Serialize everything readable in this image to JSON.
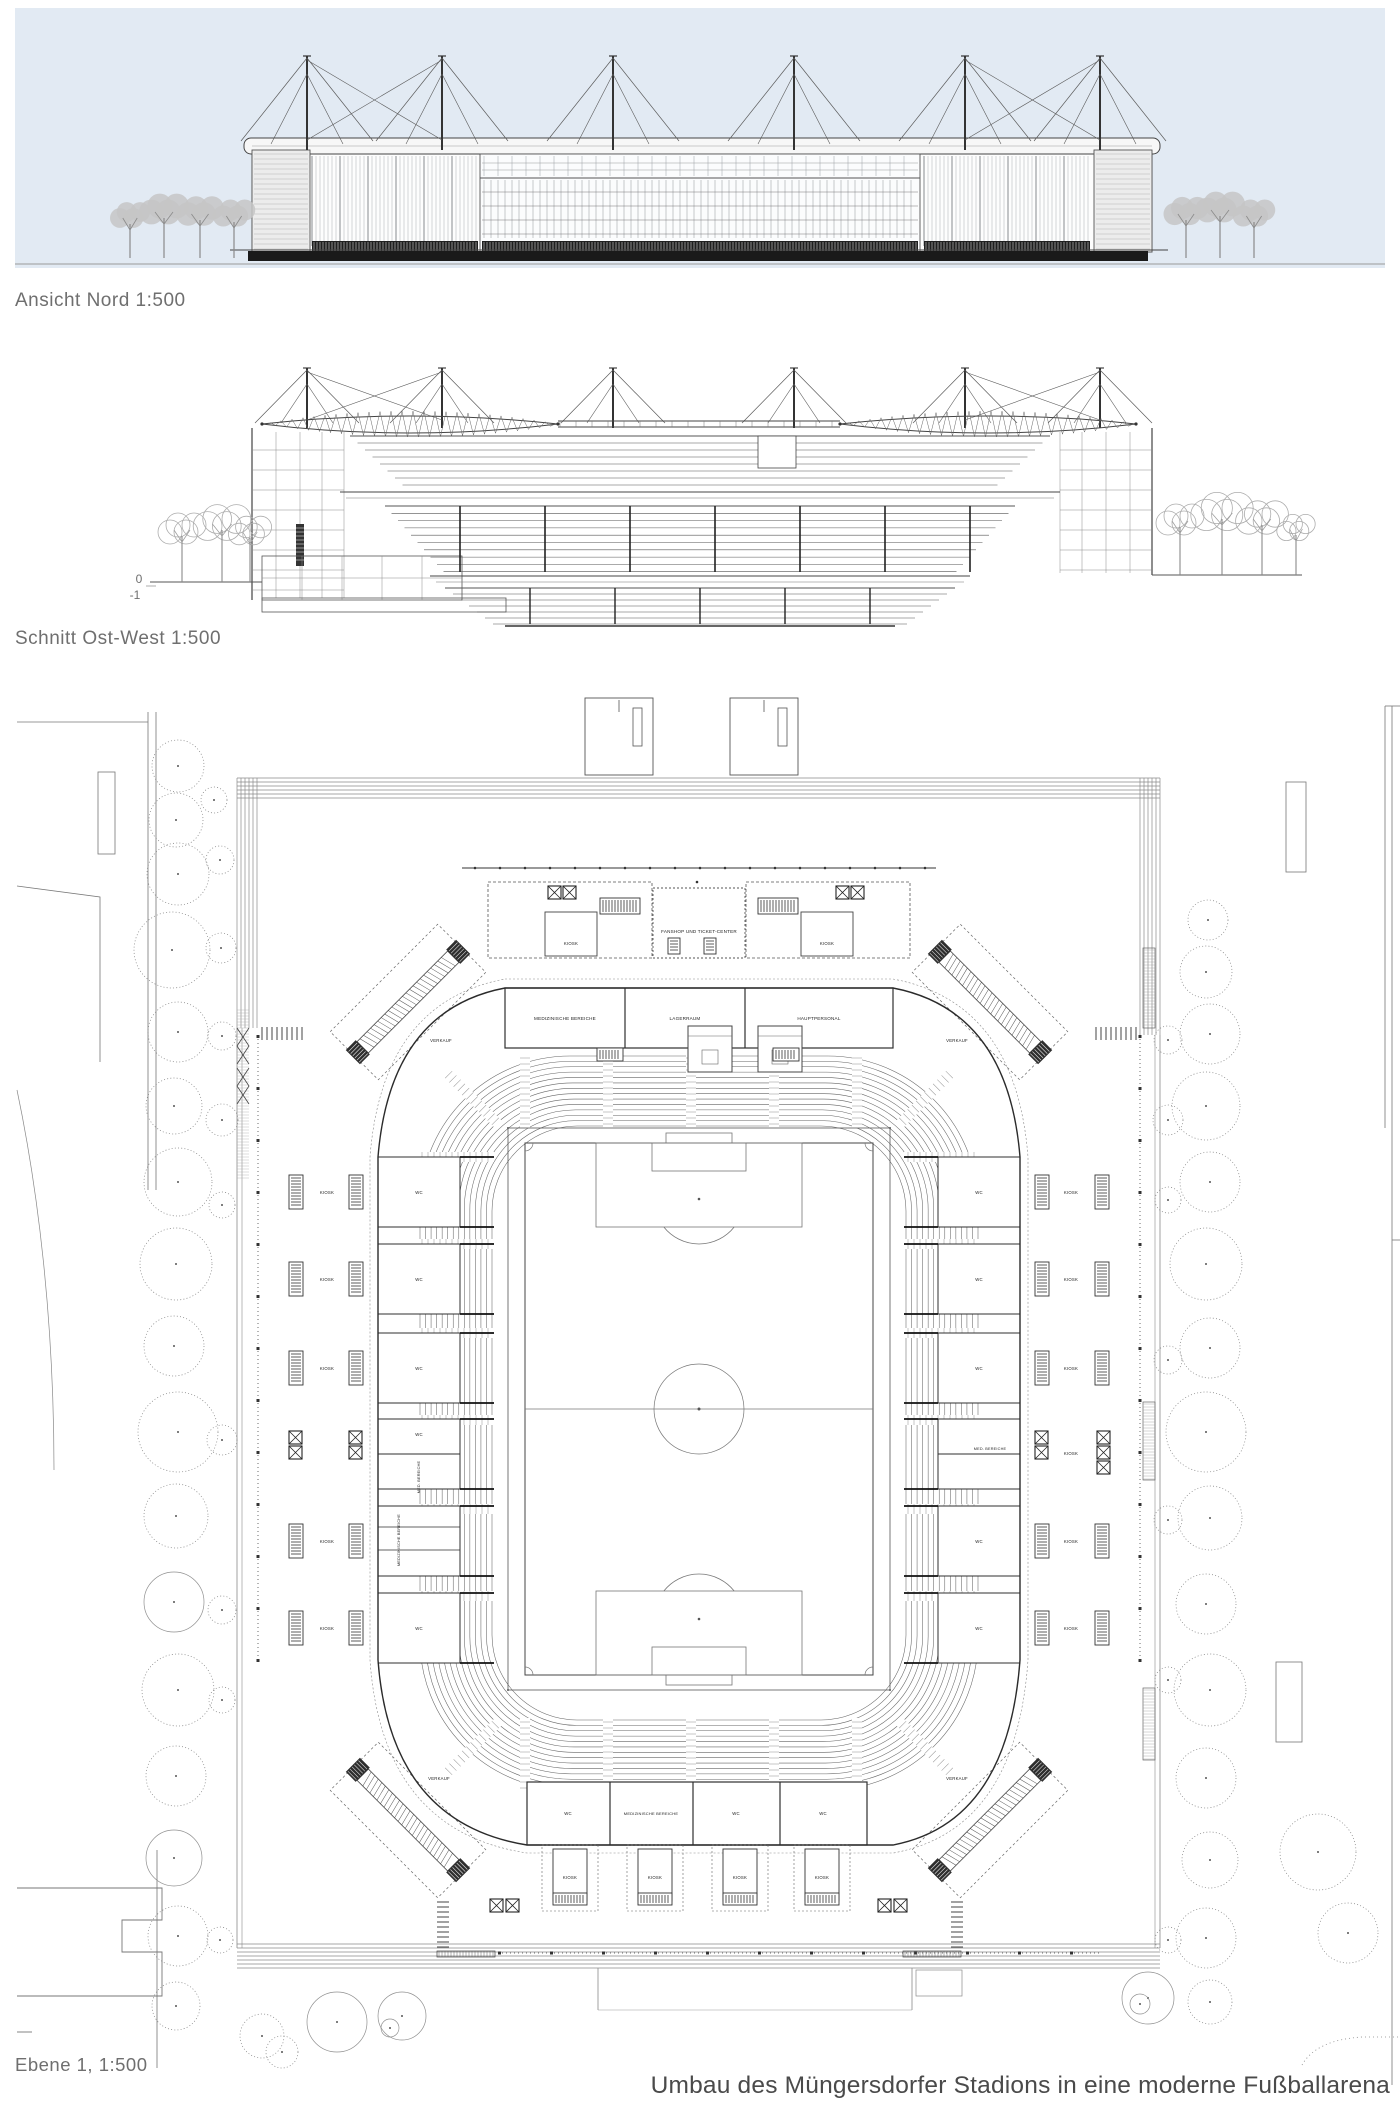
{
  "title_block": {
    "text": "Umbau des Müngersdorfer Stadions in eine moderne Fußballarena"
  },
  "captions": {
    "elevation": "Ansicht Nord 1:500",
    "section": "Schnitt Ost-West 1:500",
    "plan": "Ebene 1, 1:500"
  },
  "section": {
    "level_upper": "0",
    "level_lower": "-1"
  },
  "colors": {
    "sky": "#e2eaf3",
    "ground": "#1a1a1a",
    "ink": "#4a4a4a",
    "caption": "#6f6f6f"
  },
  "plan": {
    "labels": [
      {
        "text": "FANSHOP UND TICKET-CENTER",
        "x": 699,
        "y": 933,
        "size": 4.6
      },
      {
        "text": "KIOSK",
        "x": 571,
        "y": 945
      },
      {
        "text": "KIOSK",
        "x": 827,
        "y": 945
      },
      {
        "text": "MEDIZINISCHE BEREICHE",
        "x": 565,
        "y": 1020,
        "size": 4.6
      },
      {
        "text": "LAGERRAUM",
        "x": 685,
        "y": 1020,
        "size": 4.6
      },
      {
        "text": "HAUPTPERSONAL",
        "x": 819,
        "y": 1020,
        "size": 4.6
      },
      {
        "text": "VERKAUF",
        "x": 441,
        "y": 1042
      },
      {
        "text": "VERKAUF",
        "x": 957,
        "y": 1042
      },
      {
        "text": "KIOSK",
        "x": 327,
        "y": 1194
      },
      {
        "text": "KIOSK",
        "x": 327,
        "y": 1281
      },
      {
        "text": "KIOSK",
        "x": 327,
        "y": 1370
      },
      {
        "text": "KIOSK",
        "x": 327,
        "y": 1543
      },
      {
        "text": "KIOSK",
        "x": 327,
        "y": 1630
      },
      {
        "text": "WC",
        "x": 419,
        "y": 1194
      },
      {
        "text": "WC",
        "x": 419,
        "y": 1281
      },
      {
        "text": "WC",
        "x": 419,
        "y": 1370
      },
      {
        "text": "WC",
        "x": 419,
        "y": 1436
      },
      {
        "text": "WC",
        "x": 419,
        "y": 1630
      },
      {
        "text": "MED. BEREICHE",
        "x": 420,
        "y": 1477,
        "rot": -90,
        "size": 3.8
      },
      {
        "text": "MEDIZINISCHE BEREICHE",
        "x": 400,
        "y": 1540,
        "rot": -90,
        "size": 3.8
      },
      {
        "text": "WC",
        "x": 979,
        "y": 1194
      },
      {
        "text": "WC",
        "x": 979,
        "y": 1281
      },
      {
        "text": "WC",
        "x": 979,
        "y": 1370
      },
      {
        "text": "WC",
        "x": 979,
        "y": 1543
      },
      {
        "text": "WC",
        "x": 979,
        "y": 1630
      },
      {
        "text": "MED. BEREICHE",
        "x": 990,
        "y": 1450,
        "size": 3.8
      },
      {
        "text": "KIOSK",
        "x": 1071,
        "y": 1194
      },
      {
        "text": "KIOSK",
        "x": 1071,
        "y": 1281
      },
      {
        "text": "KIOSK",
        "x": 1071,
        "y": 1370
      },
      {
        "text": "KIOSK",
        "x": 1071,
        "y": 1455
      },
      {
        "text": "KIOSK",
        "x": 1071,
        "y": 1543
      },
      {
        "text": "KIOSK",
        "x": 1071,
        "y": 1630
      },
      {
        "text": "VERKAUF",
        "x": 439,
        "y": 1780
      },
      {
        "text": "VERKAUF",
        "x": 957,
        "y": 1780
      },
      {
        "text": "WC",
        "x": 568,
        "y": 1815
      },
      {
        "text": "MEDIZINISCHE BEREICHE",
        "x": 651,
        "y": 1815,
        "size": 4.0
      },
      {
        "text": "WC",
        "x": 736,
        "y": 1815
      },
      {
        "text": "WC",
        "x": 823,
        "y": 1815
      },
      {
        "text": "KIOSK",
        "x": 570,
        "y": 1879
      },
      {
        "text": "KIOSK",
        "x": 655,
        "y": 1879
      },
      {
        "text": "KIOSK",
        "x": 740,
        "y": 1879
      },
      {
        "text": "KIOSK",
        "x": 822,
        "y": 1879
      }
    ]
  }
}
